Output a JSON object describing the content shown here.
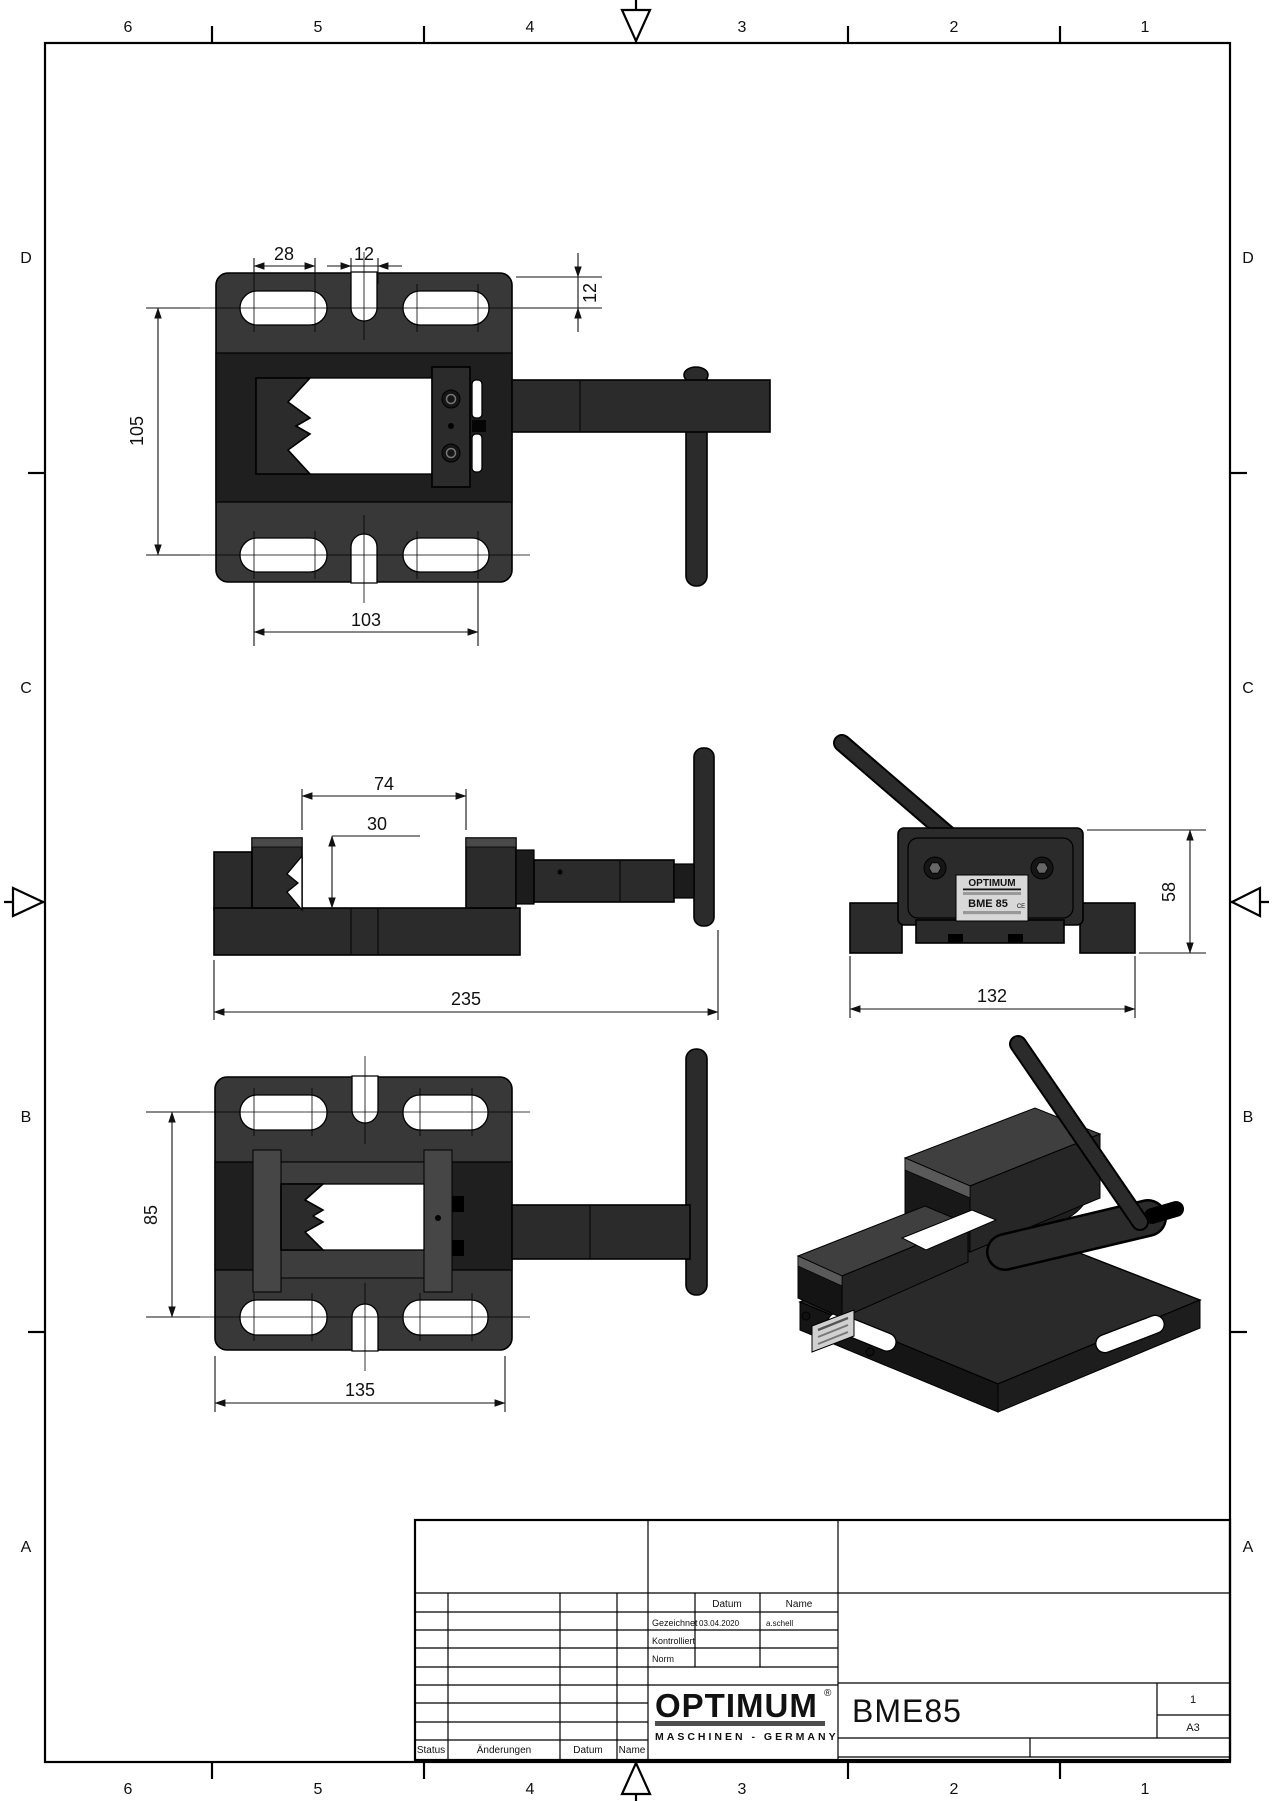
{
  "sheet": {
    "zones_top": [
      "6",
      "5",
      "4",
      "3",
      "2",
      "1"
    ],
    "zones_bottom": [
      "6",
      "5",
      "4",
      "3",
      "2",
      "1"
    ],
    "zones_left": [
      "D",
      "C",
      "B",
      "A"
    ],
    "zones_right": [
      "D",
      "C",
      "B",
      "A"
    ]
  },
  "dimensions": {
    "top_view": {
      "slot_length": "28",
      "notch_width": "12",
      "edge_offset": "12",
      "body_height": "105",
      "hole_spacing": "103"
    },
    "front_view": {
      "jaw_opening": "74",
      "jaw_depth": "30",
      "overall_length": "235"
    },
    "side_view": {
      "overall_height": "58",
      "base_width": "132"
    },
    "bottom_view": {
      "body_height": "85",
      "base_length": "135"
    }
  },
  "nameplate": {
    "brand": "OPTIMUM",
    "model": "BME 85",
    "ce": "CE"
  },
  "title_block": {
    "header": {
      "datum": "Datum",
      "name": "Name"
    },
    "rows": [
      {
        "label": "Gezeichnet",
        "datum": "03.04.2020",
        "name": "a.schell"
      },
      {
        "label": "Kontrolliert",
        "datum": "",
        "name": ""
      },
      {
        "label": "Norm",
        "datum": "",
        "name": ""
      }
    ],
    "revision_footer": {
      "status": "Status",
      "aenderungen": "Änderungen",
      "datum": "Datum",
      "name": "Name"
    },
    "logo": {
      "brand": "OPTIMUM",
      "registered": "®",
      "subtitle": "MASCHINEN - GERMANY"
    },
    "part_number": "BME85",
    "sheet_number": "1",
    "format": "A3"
  }
}
